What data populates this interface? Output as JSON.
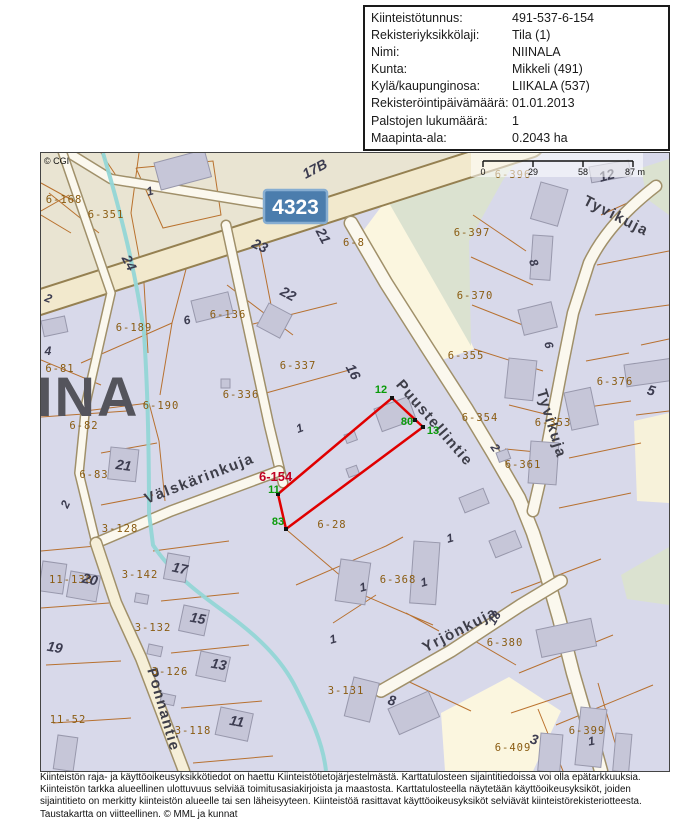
{
  "info_table": {
    "rows": [
      {
        "label": "Kiinteistötunnus:",
        "value": "491-537-6-154"
      },
      {
        "label": "Rekisteriyksikkölaji:",
        "value": "Tila (1)"
      },
      {
        "label": "Nimi:",
        "value": "NIINALA"
      },
      {
        "label": "Kunta:",
        "value": "Mikkeli (491)"
      },
      {
        "label": "Kylä/kaupunginosa:",
        "value": "LIIKALA (537)"
      },
      {
        "label": "Rekisteröintipäivämäärä:",
        "value": "01.01.2013"
      },
      {
        "label": "Palstojen lukumäärä:",
        "value": "1"
      },
      {
        "label": "Maapinta-ala:",
        "value": "0.2043 ha"
      }
    ]
  },
  "map": {
    "copyright": "© CGI",
    "road_sign": "4323",
    "map_name_fragment": "INA",
    "scale_bar": {
      "ticks": [
        "0",
        "29",
        "58",
        "87 m"
      ]
    },
    "target_parcel": {
      "id": "6-154",
      "boundary_points": [
        {
          "n": "12"
        },
        {
          "n": "80"
        },
        {
          "n": "13"
        },
        {
          "n": "11"
        },
        {
          "n": "83"
        }
      ]
    },
    "streets": [
      {
        "name": "Puustellintie"
      },
      {
        "name": "Tyvikuja"
      },
      {
        "name": "Tyvikuja"
      },
      {
        "name": "Välskärinkuja"
      },
      {
        "name": "Yrjönkuja"
      },
      {
        "name": "Ponnantie"
      }
    ],
    "parcels": [
      {
        "id": "6-168"
      },
      {
        "id": "6-351"
      },
      {
        "id": "6-189"
      },
      {
        "id": "6-136"
      },
      {
        "id": "6-81"
      },
      {
        "id": "6-82"
      },
      {
        "id": "6-190"
      },
      {
        "id": "6-336"
      },
      {
        "id": "6-337"
      },
      {
        "id": "6-8"
      },
      {
        "id": "6-83"
      },
      {
        "id": "3-128"
      },
      {
        "id": "6-28"
      },
      {
        "id": "6-355"
      },
      {
        "id": "6-397"
      },
      {
        "id": "6-370"
      },
      {
        "id": "6-396"
      },
      {
        "id": "6-376"
      },
      {
        "id": "6-354"
      },
      {
        "id": "6-353"
      },
      {
        "id": "6-361"
      },
      {
        "id": "6-368"
      },
      {
        "id": "6-380"
      },
      {
        "id": "3-131"
      },
      {
        "id": "6-399"
      },
      {
        "id": "6-409"
      },
      {
        "id": "11-138"
      },
      {
        "id": "11-52"
      },
      {
        "id": "3-142"
      },
      {
        "id": "3-132"
      },
      {
        "id": "3-126"
      },
      {
        "id": "3-118"
      }
    ],
    "house_numbers": [
      {
        "n": "1"
      },
      {
        "n": "17B"
      },
      {
        "n": "21"
      },
      {
        "n": "23"
      },
      {
        "n": "24"
      },
      {
        "n": "2"
      },
      {
        "n": "22"
      },
      {
        "n": "6"
      },
      {
        "n": "4"
      },
      {
        "n": "21"
      },
      {
        "n": "2"
      },
      {
        "n": "19"
      },
      {
        "n": "20"
      },
      {
        "n": "17"
      },
      {
        "n": "15"
      },
      {
        "n": "13"
      },
      {
        "n": "11"
      },
      {
        "n": "16"
      },
      {
        "n": "12"
      },
      {
        "n": "8"
      },
      {
        "n": "6"
      },
      {
        "n": "2"
      },
      {
        "n": "5"
      },
      {
        "n": "1"
      },
      {
        "n": "1"
      },
      {
        "n": "1"
      },
      {
        "n": "1"
      },
      {
        "n": "1"
      },
      {
        "n": "8"
      },
      {
        "n": "1"
      },
      {
        "n": "3"
      },
      {
        "n": "18"
      }
    ]
  },
  "footer": {
    "lines": [
      "Kiinteistön raja- ja käyttöoikeusyksikkötiedot on haettu Kiinteistötietojärjestelmästä. Karttatulosteen sijaintitiedoissa voi olla epätarkkuuksia.",
      "Kiinteistön tarkka alueellinen ulottuvuus selviää toimitusasiakirjoista ja maastosta. Karttatulosteella näytetään käyttöoikeusyksiköt, joiden",
      "sijaintitieto on merkitty kiinteistön alueelle tai sen läheisyyteen. Kiinteistöä rasittavat käyttöoikeusyksiköt selviävät kiinteistörekisteriotteesta.",
      "Taustakartta on viitteellinen. © MML ja kunnat"
    ]
  },
  "colors": {
    "target_boundary": "#e00000",
    "boundary_point_label": "#0a9b0a",
    "parcel_line": "#b4651c",
    "parcel_label": "#8a5c12",
    "road_sign_bg": "#4b7dad",
    "water": "#93d6d6"
  }
}
